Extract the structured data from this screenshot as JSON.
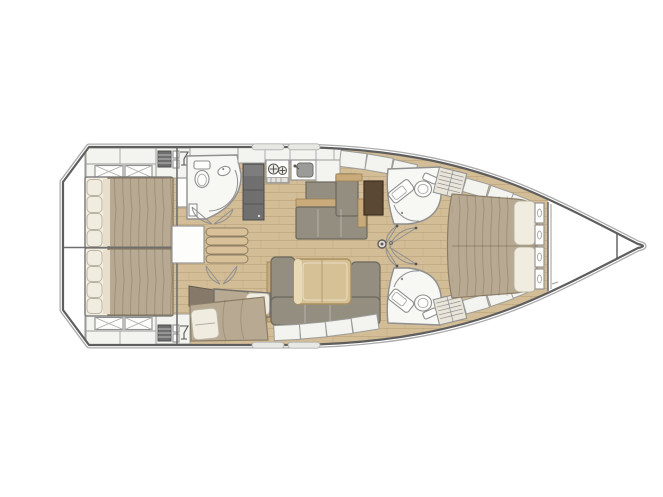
{
  "meta": {
    "title": "Sailing yacht interior layout plan, top-down view, bow pointing right",
    "figure_type": "boat floor plan"
  },
  "palette": {
    "hullStroke": "#5e5e5e",
    "hullOuter": "#ababab",
    "wood": "#d3bd97",
    "woodSeam": "#a98f68",
    "counter": "#f3f3f0",
    "counterStroke": "#9b9b98",
    "room": "#f7f7f4",
    "line": "#8f8f8f",
    "sofa": "#938e80",
    "sofaDark": "#6c685c",
    "trim": "#c9aa7b",
    "trimStroke": "#9d8152",
    "table": "#d6c196",
    "tableLight": "#e8dab6",
    "tableStroke": "#aa905e",
    "desk": "#5b4834",
    "deskStroke": "#3b2e21",
    "blanket": "#b8a992",
    "blanketStroke": "#8a7d66",
    "pillow": "#f1ece0",
    "pillowStroke": "#bab3a1",
    "appliance": "#6f6f6f",
    "applianceDark": "#4d4d4d",
    "steps": "#d8c198",
    "stepsStroke": "#8f7f63",
    "hatch": "#e9e5db",
    "wedge": "#86796a",
    "wall": "#6f6f6f"
  },
  "layout": {
    "bow_direction": "right",
    "rooms": [
      {
        "id": "aft-cabin-port",
        "label": "Aft double cabin (port)",
        "features": [
          "double berth",
          "segmented headboard cushions",
          "x-front lockers",
          "louvred locker",
          "glass locker"
        ]
      },
      {
        "id": "aft-cabin-starboard",
        "label": "Aft double cabin (starboard)",
        "features": [
          "double berth",
          "segmented headboard cushions",
          "x-front lockers",
          "louvred locker",
          "glass locker"
        ]
      },
      {
        "id": "companionway",
        "label": "Companionway",
        "features": [
          "four steps",
          "engine-room access box"
        ]
      },
      {
        "id": "head-port",
        "label": "Port head with shower",
        "features": [
          "marine toilet",
          "washbasin",
          "curved shower screen",
          "double door"
        ]
      },
      {
        "id": "galley",
        "label": "Galley (port side)",
        "features": [
          "tall refrigerator unit",
          "two-burner stove",
          "sink with faucet",
          "worktop lockers"
        ]
      },
      {
        "id": "nav-station",
        "label": "Chart table with L-shaped seat",
        "features": [
          "dark chart table",
          "L-settee with wood trim"
        ]
      },
      {
        "id": "saloon",
        "label": "Saloon dinette (starboard)",
        "features": [
          "U-shaped settee",
          "folding table with centre leaf",
          "hull-side lockers"
        ]
      },
      {
        "id": "bunk-cabin",
        "label": "Midship bunk cabin",
        "features": [
          "two angled single berths",
          "double door"
        ]
      },
      {
        "id": "head-forward-port",
        "label": "Forward head (port)",
        "features": [
          "marine toilet",
          "angled vanity washbasin",
          "door arc"
        ]
      },
      {
        "id": "head-forward-starboard",
        "label": "Forward head (starboard)",
        "features": [
          "marine toilet",
          "angled vanity washbasin",
          "door arc"
        ]
      },
      {
        "id": "owner-cabin",
        "label": "Forward owner cabin",
        "features": [
          "island double berth",
          "twin pillows",
          "button-tufted headboard",
          "hull-side lockers",
          "louvred panels"
        ]
      },
      {
        "id": "forepeak",
        "label": "Forepeak locker",
        "features": [
          "collision bulkhead"
        ]
      }
    ]
  }
}
